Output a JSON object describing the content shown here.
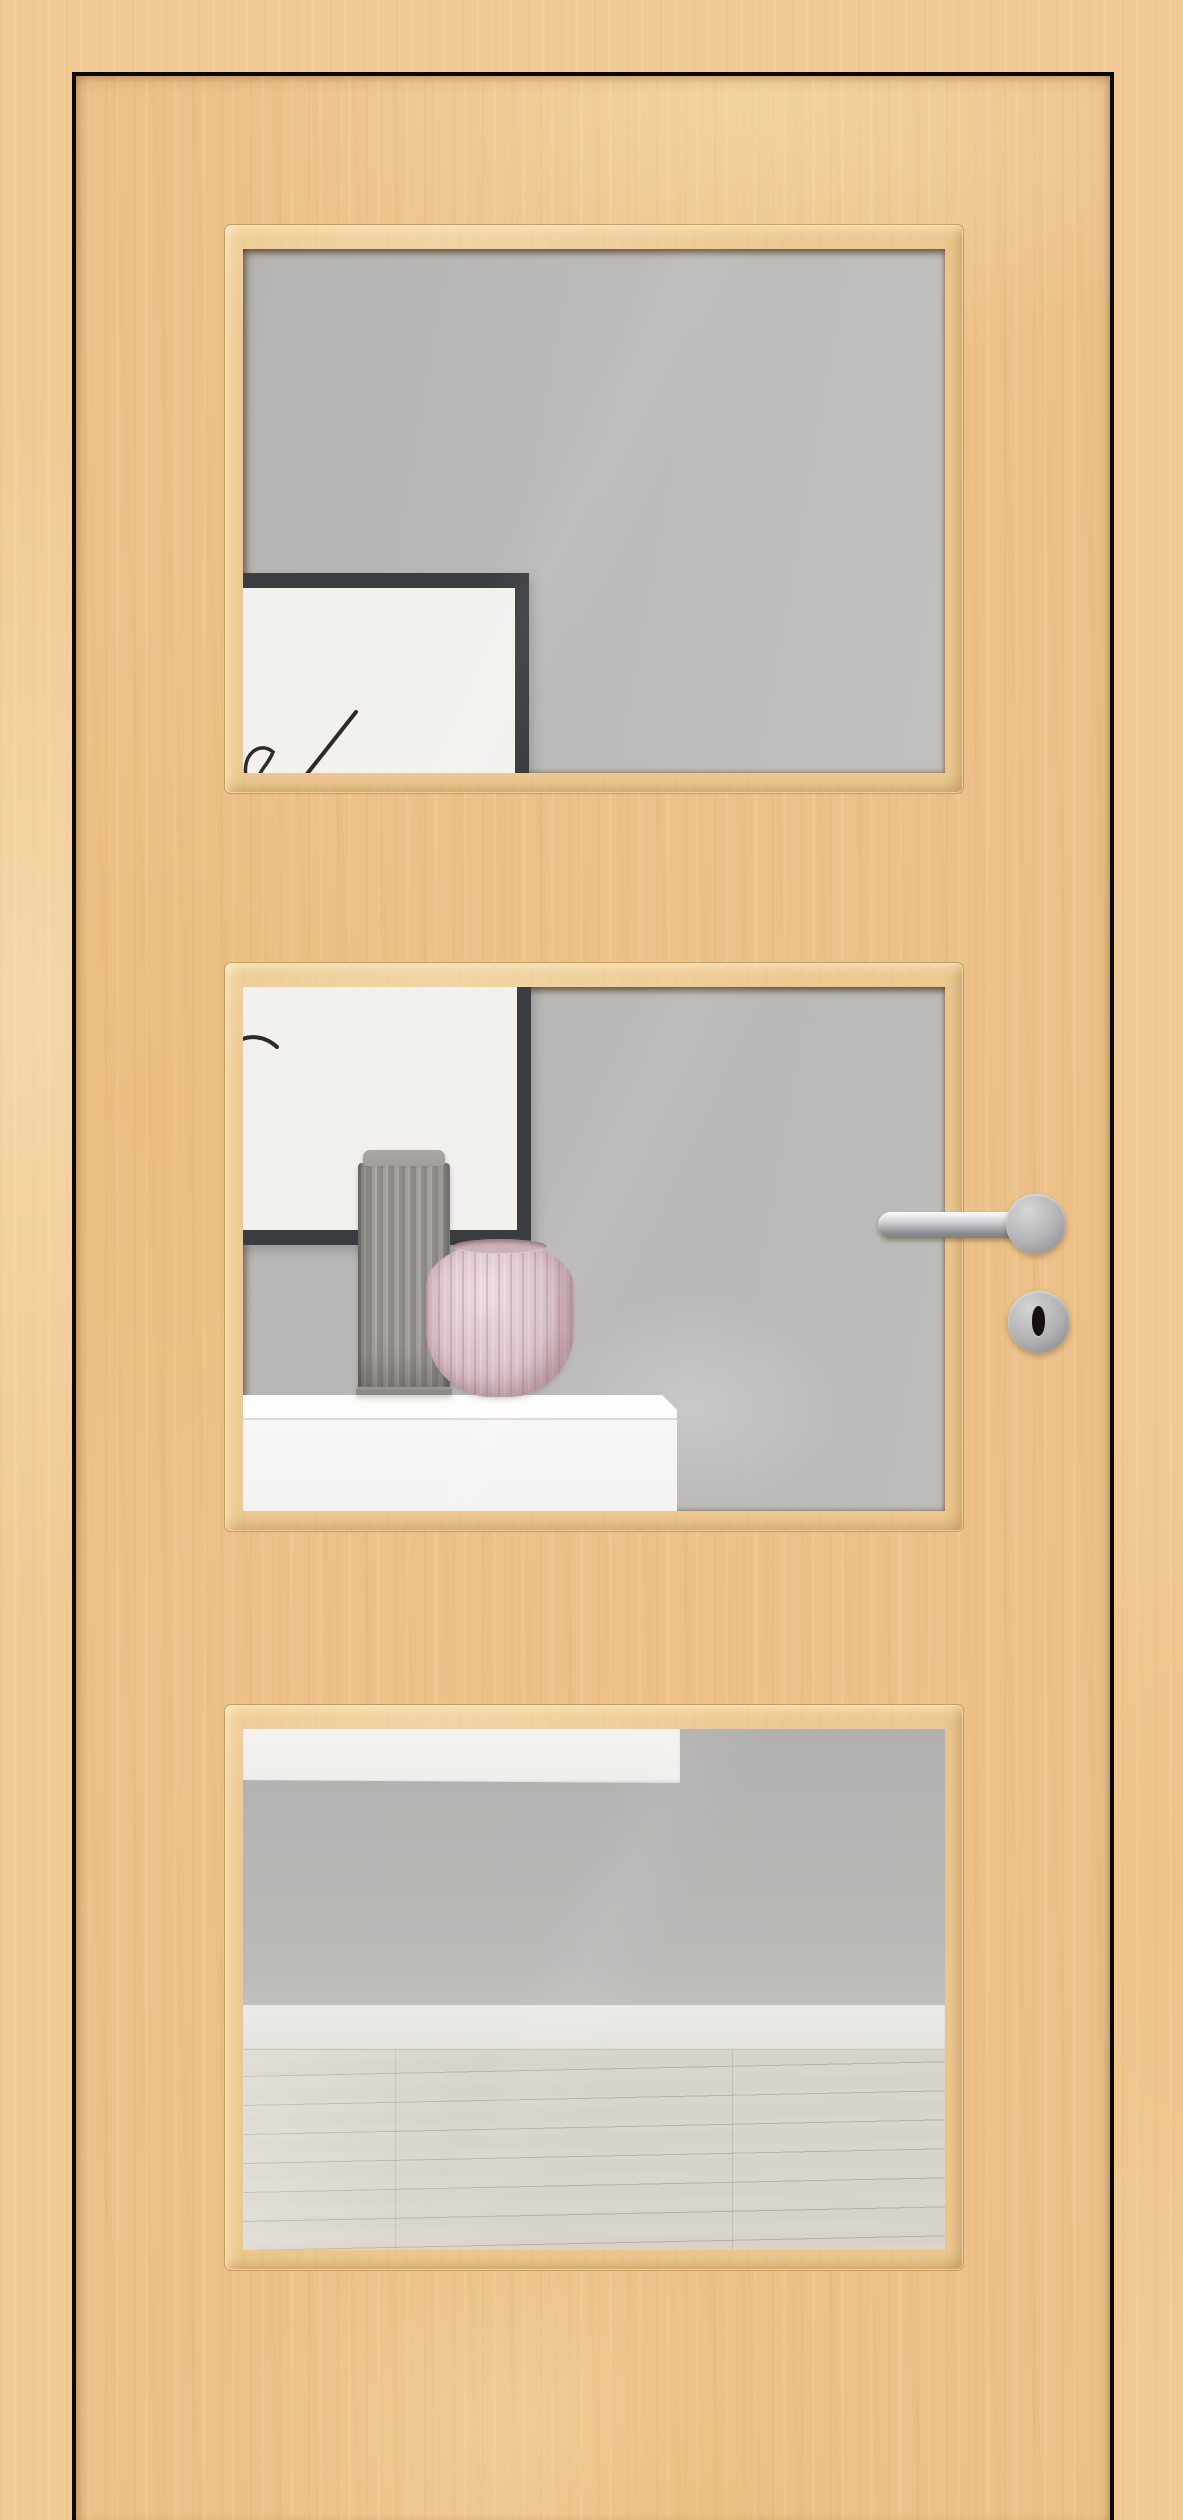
{
  "image": {
    "width_px": 1183,
    "height_px": 2520
  },
  "scene": {
    "subject": "interior wood door with three glass panels, closed in its frame",
    "door": {
      "material": "light birch/maple veneer",
      "glazing_panels": 3,
      "hardware": [
        "stainless-steel lever handle on round rosette",
        "round keyhole escutcheon"
      ]
    },
    "room_behind_glass": {
      "panel_1": [
        "gray wall",
        "black picture frame with white abstract line art"
      ],
      "panel_2": [
        "gray wall",
        "bottom of black picture frame",
        "gray fluted vase",
        "pink ribbed vase",
        "white sideboard"
      ],
      "panel_3": [
        "underside of white sideboard",
        "gray wall",
        "white baseboard",
        "light wood plank floor"
      ]
    }
  },
  "colors": {
    "wood_frame": "#f0c994",
    "wood_leaf": "#ecc189",
    "gap_black": "#0c0804",
    "bead": "#edc992",
    "glass_wall": "#b9b8b6",
    "frame_black": "#3a3d40",
    "art_white": "#f3f1ee",
    "art_stroke": "#2e2a27",
    "sideboard_white": "#f6f5f3",
    "sideboard_top": "#fdfdfb",
    "vase_gray": "#9b9894",
    "vase_gray_cap": "#a19e9a",
    "vase_pink": "#d6bdc2",
    "vase_pink_rim": "#cdb2b8",
    "baseboard": "#edebe7",
    "floor": "#d7d2ca",
    "metal": "#b6b8ba",
    "metal_dark": "#85878a",
    "keyhole": "#141110"
  }
}
